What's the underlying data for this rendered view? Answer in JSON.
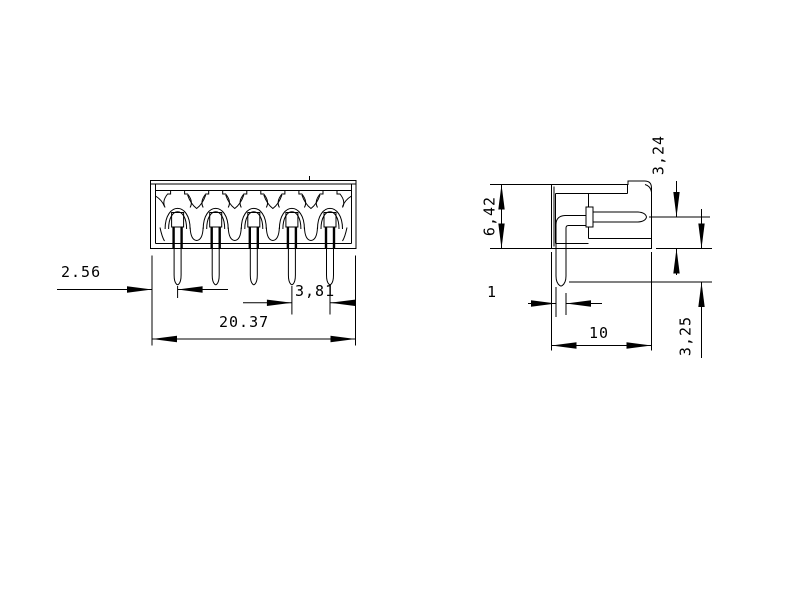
{
  "drawing": {
    "type": "engineering-dimension-drawing",
    "part": "5-pin connector header",
    "colors": {
      "line": "#000000",
      "background": "#ffffff"
    },
    "front_view": {
      "pin_count": 5
    },
    "dimensions": {
      "front": {
        "edge_to_first_pin": "2.56",
        "pin_pitch": "3,81",
        "overall_width": "20.37"
      },
      "side": {
        "body_height": "6,42",
        "pin_center_to_body_bottom": "3,24",
        "pin_tail_below_body": "3,25",
        "pin_thickness": "1",
        "body_depth": "10"
      }
    }
  }
}
